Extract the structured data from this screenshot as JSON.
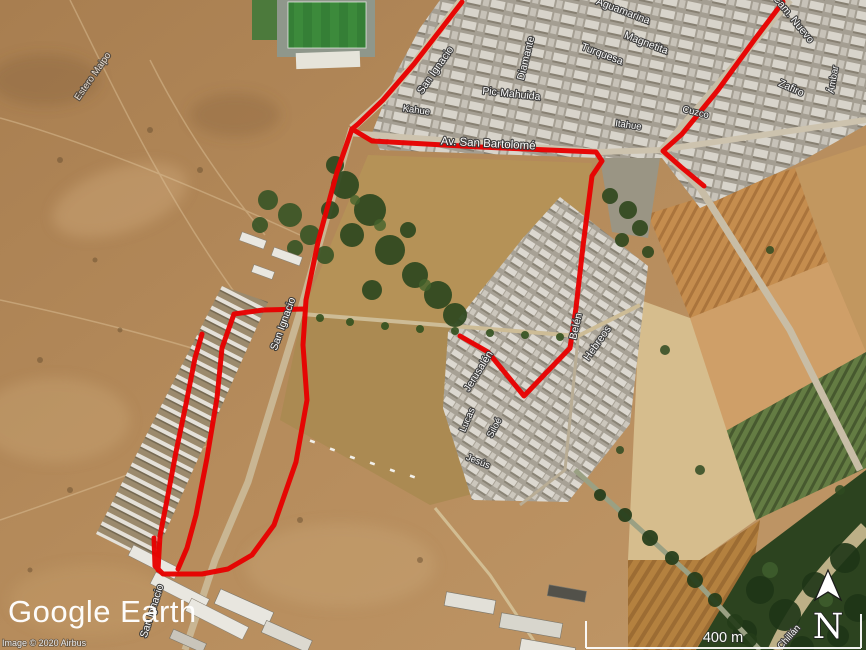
{
  "app": {
    "name": "Google Earth"
  },
  "map": {
    "logo": "Google Earth",
    "copyright": "Image © 2020 Airbus",
    "scale_bar": {
      "label": "400 m"
    },
    "north_indicator": {
      "letter": "N"
    },
    "route_color": "#e80000",
    "street_labels": [
      {
        "text": "Estero Maipo"
      },
      {
        "text": "San Ignacio"
      },
      {
        "text": "Aguamarina"
      },
      {
        "text": "Turquesa"
      },
      {
        "text": "Magnetita"
      },
      {
        "text": "Diamante"
      },
      {
        "text": "Pic-Mahuida"
      },
      {
        "text": "Kahue"
      },
      {
        "text": "Itahue"
      },
      {
        "text": "Av. San Bartolomé"
      },
      {
        "text": "Cam. Nuevo"
      },
      {
        "text": "Zafiro"
      },
      {
        "text": "Ámbar"
      },
      {
        "text": "Cuzco"
      },
      {
        "text": "San Ignacio"
      },
      {
        "text": "Jerusalén"
      },
      {
        "text": "Belén"
      },
      {
        "text": "Hebreos"
      },
      {
        "text": "Lucas"
      },
      {
        "text": "Siloé"
      },
      {
        "text": "Jesús"
      },
      {
        "text": "San Ignacio"
      },
      {
        "text": "Chillán"
      }
    ]
  }
}
